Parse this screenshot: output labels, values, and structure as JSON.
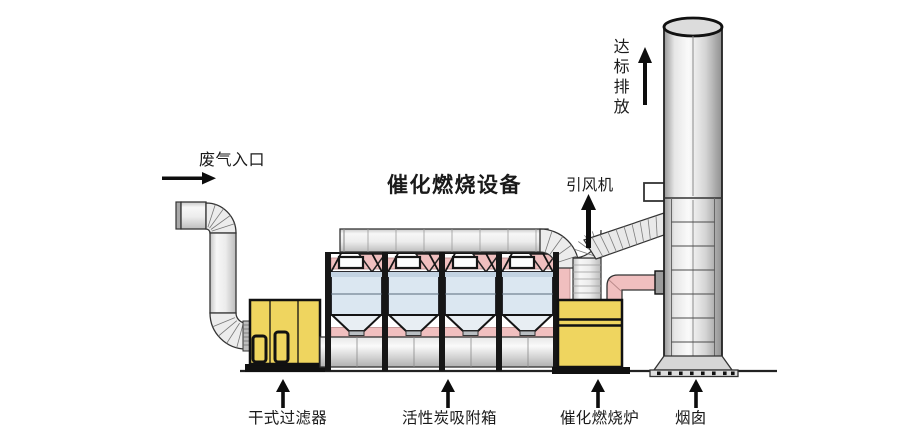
{
  "title": "催化燃烧设备",
  "annotations": {
    "inlet": "废气入口",
    "fan": "引风机",
    "emission": "达标排放"
  },
  "equipment_labels": {
    "dry_filter": "干式过滤器",
    "carbon_adsorption_box": "活性炭吸附箱",
    "catalytic_furnace": "催化燃烧炉",
    "chimney": "烟囱"
  },
  "colors": {
    "equipment_yellow": "#efd55f",
    "pipe_pink": "#f0bfbf",
    "cabinet_blue": "#dbe7f1",
    "duct_gray": "#ececec",
    "outline_black": "#1a1a1a"
  }
}
